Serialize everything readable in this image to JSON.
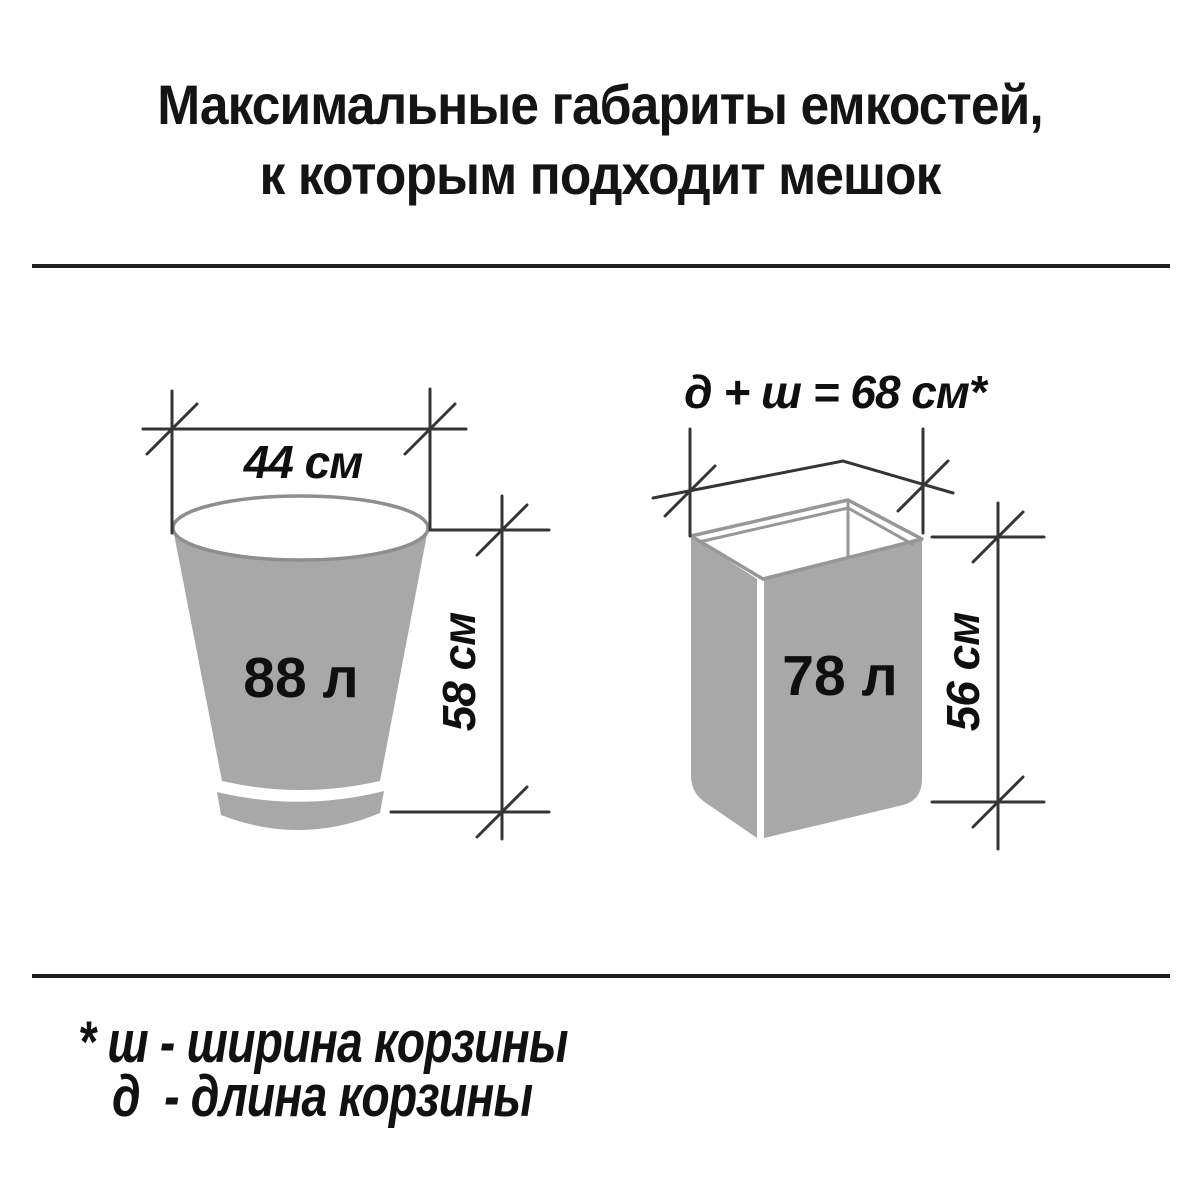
{
  "title": {
    "line1": "Максимальные габариты емкостей,",
    "line2": "к которым подходит мешок"
  },
  "bucket": {
    "shape": "round-tapered-bucket",
    "volume_label": "88 л",
    "width_label": "44 см",
    "height_label": "58 см"
  },
  "basket": {
    "shape": "rectangular-basket",
    "volume_label": "78 л",
    "dimension_sum_label": "д + ш = 68 см*",
    "height_label": "56 см"
  },
  "footnote": {
    "line1": "* ш - ширина корзины",
    "line2": "д  - длина корзины"
  },
  "colors": {
    "background": "#ffffff",
    "container_fill": "#a8a8a8",
    "container_outline": "#8e8e8e",
    "dimension_line": "#353535",
    "text": "#0f0f0f",
    "divider": "#1f1f1f"
  }
}
